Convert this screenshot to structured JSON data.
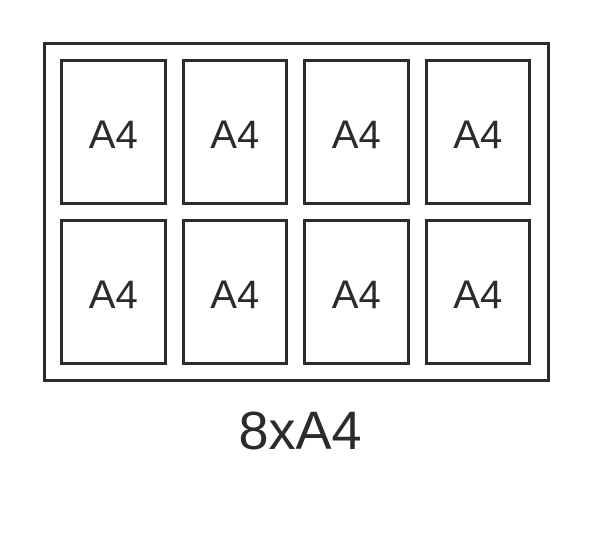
{
  "diagram": {
    "caption": "8xA4",
    "grid": {
      "rows": 2,
      "cols": 4,
      "panel_count": 8
    },
    "panels": [
      {
        "label": "A4"
      },
      {
        "label": "A4"
      },
      {
        "label": "A4"
      },
      {
        "label": "A4"
      },
      {
        "label": "A4"
      },
      {
        "label": "A4"
      },
      {
        "label": "A4"
      },
      {
        "label": "A4"
      }
    ],
    "colors": {
      "line": "#2b2b2b",
      "text": "#2b2b2b",
      "background": "#ffffff"
    }
  }
}
